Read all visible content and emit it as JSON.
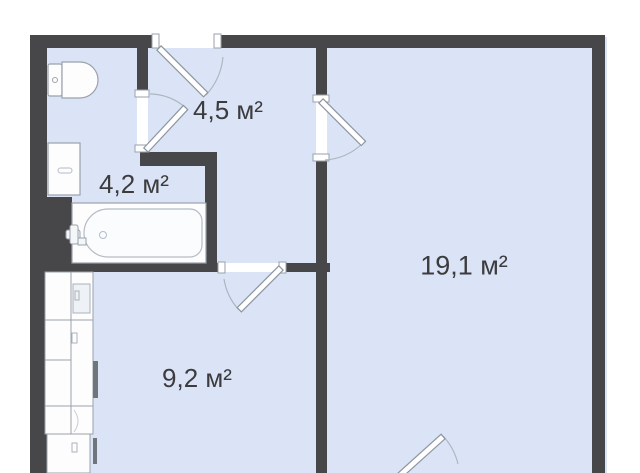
{
  "page": {
    "type": "apartment-floor-plan",
    "background_color": "#ffffff"
  },
  "floor_plan": {
    "area_unit": "м²",
    "rooms": {
      "hallway": {
        "name": "hallway",
        "area_label": "4,5 м²"
      },
      "bathroom": {
        "name": "bathroom",
        "area_label": "4,2 м²"
      },
      "kitchen": {
        "name": "kitchen",
        "area_label": "9,2 м²"
      },
      "living_room": {
        "name": "living-room",
        "area_label": "19,1 м²"
      }
    },
    "fixtures": [
      "toilet",
      "sink",
      "bathtub",
      "kitchen-cabinets",
      "entrance-door",
      "bathroom-door",
      "living-room-door",
      "kitchen-door",
      "balcony-door"
    ],
    "colors": {
      "wall": "#47474a",
      "floor": "#dbe4f6",
      "fixture_fill": "#fdfdfe",
      "fixture_outline": "#9aa2ac",
      "door_arc": "#adb6c0",
      "label_text": "#3c3c3e",
      "background": "#ffffff"
    }
  }
}
